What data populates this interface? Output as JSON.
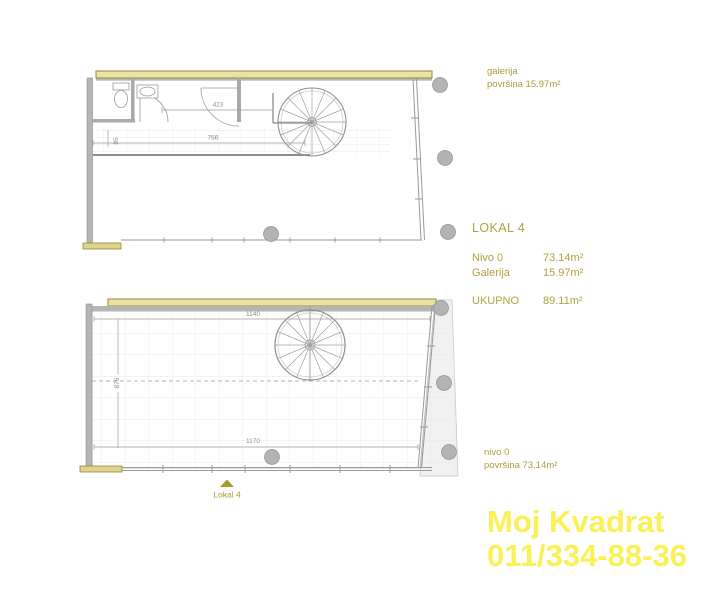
{
  "colors": {
    "accent_olive": "#ab9d3c",
    "watermark_yellow": "#f9f155",
    "wall_yellow_fill": "#e9e3a4",
    "wall_yellow_border": "#938a2f",
    "wall_gray": "#b5b5b5",
    "line_gray": "#9a9a9a",
    "dim_text_gray": "#8a8a8a"
  },
  "upper_plan": {
    "dim_top": "423",
    "dim_mid": "766",
    "dim_left": "95",
    "label": {
      "line1": "galerija",
      "line2": "površina 15.97m²"
    }
  },
  "summary": {
    "title": "LOKAL 4",
    "rows": [
      {
        "label": "Nivo 0",
        "value": "73.14m²"
      },
      {
        "label": "Galerija",
        "value": "15.97m²"
      }
    ],
    "total": {
      "label": "UKUPNO",
      "value": "89.11m²"
    }
  },
  "lower_plan": {
    "dim_top": "1140",
    "dim_left": "876",
    "dim_bottom": "1170",
    "entrance_label": "Lokal 4",
    "label": {
      "line1": "nivo 0",
      "line2": "površina 73.14m²"
    }
  },
  "watermark": {
    "line1": "Moj Kvadrat",
    "line2": "011/334-88-36"
  }
}
